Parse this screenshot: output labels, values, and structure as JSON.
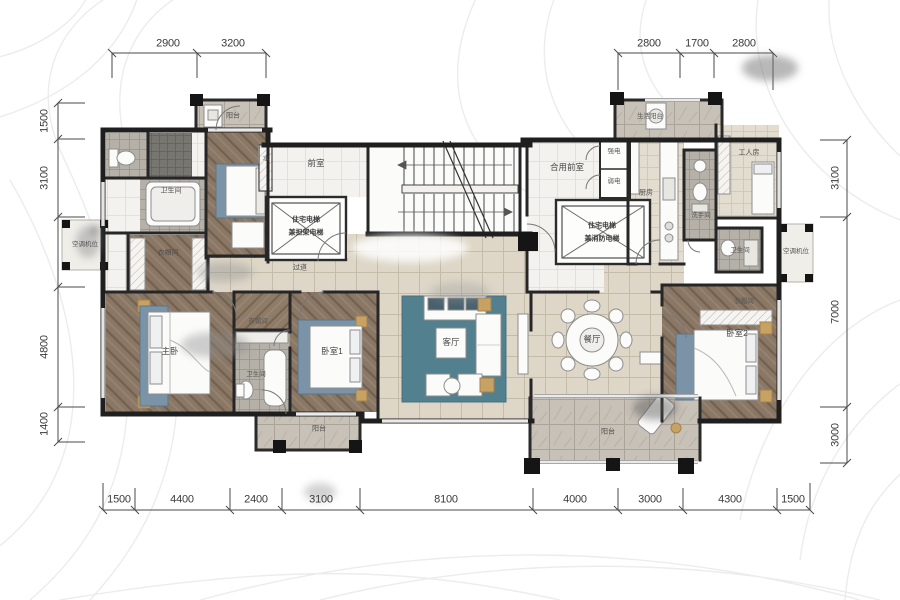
{
  "colors": {
    "wall": "#1f1f1f",
    "wood_floor": "#8a7765",
    "tile_floor": "#ded7c8",
    "bath_floor": "#b5b1a8",
    "balcony_floor": "#c8c1b7",
    "rug": "#53808f",
    "gold_accent": "#c8a263",
    "dim_text": "#3a3a3a"
  },
  "dims": {
    "top_left": [
      "2900",
      "3200"
    ],
    "top_right": [
      "2800",
      "1700",
      "2800"
    ],
    "left": [
      "1500",
      "3100",
      "",
      "4800",
      "1400"
    ],
    "right": [
      "3100",
      "7000",
      "3000"
    ],
    "bottom": [
      "1500",
      "4400",
      "2400",
      "3100",
      "8100",
      "4000",
      "3000",
      "4300",
      "1500"
    ]
  },
  "rooms": {
    "balcony_tl": "阳台",
    "bath_tl": "卫生间",
    "closet_left": "衣帽间",
    "ac_left": "空调机位",
    "water_shaft": "水",
    "front_room": "前室",
    "elevator1_l1": "住宅电梯",
    "elevator1_l2": "兼担架电梯",
    "shared_front_room": "合用前室",
    "strong_elec": "强电",
    "weak_elec": "弱电",
    "elevator2_l1": "住宅电梯",
    "elevator2_l2": "兼消防电梯",
    "kitchen": "厨房",
    "service_balcony": "生活阳台",
    "worker_room": "工人房",
    "washroom": "洗手间",
    "bath_right": "卫生间",
    "ac_right": "空调机位",
    "hallway": "过道",
    "master_bedroom": "主卧",
    "closet_master": "衣帽间",
    "bath_master": "卫生间",
    "bedroom1": "卧室1",
    "living_room": "客厅",
    "dining_room": "餐厅",
    "closet_bedroom2": "衣帽间",
    "bedroom2": "卧室2",
    "balcony_bl": "阳台",
    "balcony_br": "阳台"
  }
}
